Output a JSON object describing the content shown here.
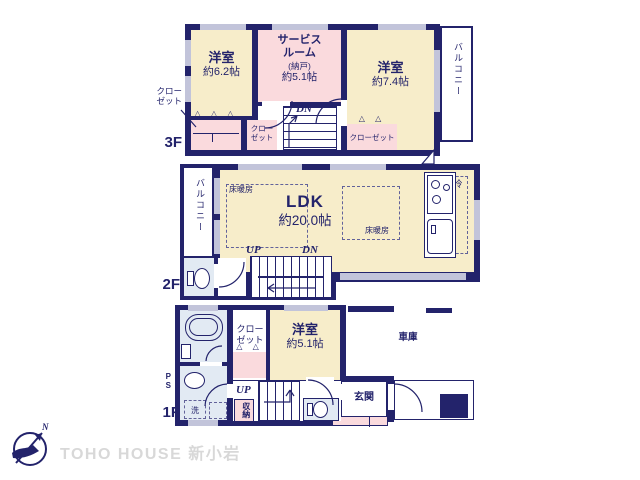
{
  "watermark": "TOHO HOUSE 新小岩",
  "compass": {
    "north": "N"
  },
  "glyphs": {
    "hangers3": "△ △ △",
    "hangers2": "△ △"
  },
  "floor3": {
    "label": "3F",
    "bedroom1": {
      "name": "洋室",
      "size": "約6.2帖"
    },
    "service": {
      "name": "サービス\nルーム",
      "sub": "(納戸)",
      "size": "約5.1帖"
    },
    "bedroom2": {
      "name": "洋室",
      "size": "約7.4帖"
    },
    "balcony": "バルコニー",
    "closet_callout": "クロー\nゼット",
    "closet_small": "クロー\nゼット",
    "closet_right": "クローゼット",
    "dn": "DN"
  },
  "floor2": {
    "label": "2F",
    "balcony": "バルコニー",
    "ldk": {
      "name": "LDK",
      "size": "約20.0帖"
    },
    "heating1": "床暖房",
    "heating2": "床暖房",
    "fridge": "冷",
    "up": "UP",
    "dn": "DN"
  },
  "floor1": {
    "label": "1F",
    "closet_label": "クロー\nゼット",
    "bedroom": {
      "name": "洋室",
      "size": "約5.1帖"
    },
    "garage": "車庫",
    "entrance": "玄関",
    "storage": "収納",
    "laundry": "洗",
    "ps": "PS",
    "up": "UP"
  },
  "colors": {
    "wall": "#23236b",
    "room_cream": "#f7edca",
    "room_pink": "#fadadd",
    "room_blue": "#e2eaf3",
    "window": "#c2c4da"
  }
}
